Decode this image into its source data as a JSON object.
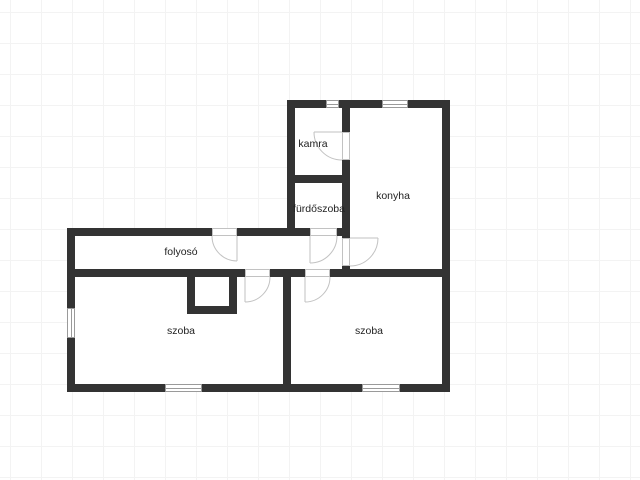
{
  "palette": {
    "wall": "#333333",
    "door_swing": "#c2c2c2",
    "window_border": "#9a9a9a",
    "label_text": "#222222",
    "grid": "#f3f3f3",
    "background": "#ffffff"
  },
  "floor_plan": {
    "type": "apartment-floor-plan",
    "rooms": [
      {
        "id": "kamra",
        "label": "kamra"
      },
      {
        "id": "konyha",
        "label": "konyha"
      },
      {
        "id": "furdoszoba",
        "label": "fürdőszoba"
      },
      {
        "id": "folyoso",
        "label": "folyosó"
      },
      {
        "id": "szoba-left",
        "label": "szoba"
      },
      {
        "id": "szoba-right",
        "label": "szoba"
      }
    ],
    "windows": [
      {
        "id": "window-kamra-north"
      },
      {
        "id": "window-konyha-north"
      },
      {
        "id": "window-szoba-left-west"
      },
      {
        "id": "window-szoba-left-south"
      },
      {
        "id": "window-szoba-right-south"
      }
    ],
    "doors": [
      {
        "id": "door-entry-folyoso"
      },
      {
        "id": "door-kamra"
      },
      {
        "id": "door-furdoszoba"
      },
      {
        "id": "door-konyha"
      },
      {
        "id": "door-szoba-left"
      },
      {
        "id": "door-szoba-right"
      }
    ]
  }
}
